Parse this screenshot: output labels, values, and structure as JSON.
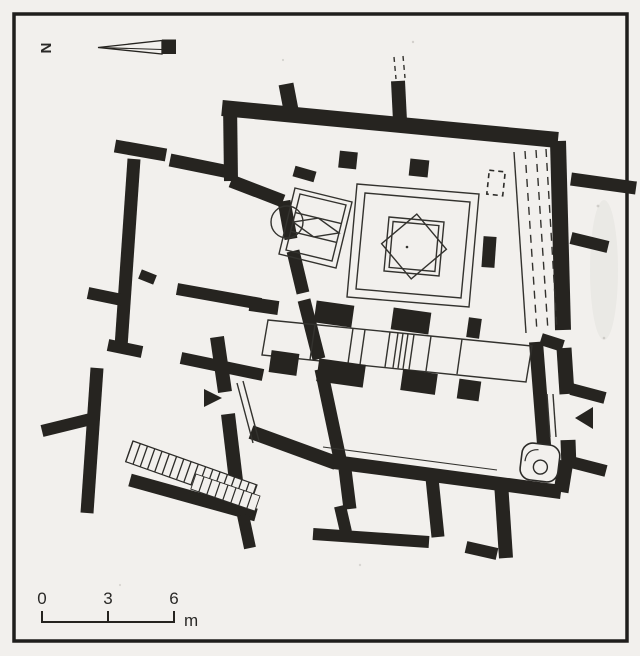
{
  "figure": {
    "kind": "scanned architectural floor plan",
    "north_label": "N",
    "scale_bar": {
      "tick_labels": [
        "0",
        "3",
        "6"
      ],
      "unit_label": "m"
    },
    "palette": {
      "paper": "#f2f0ed",
      "ink": "#262420"
    }
  }
}
